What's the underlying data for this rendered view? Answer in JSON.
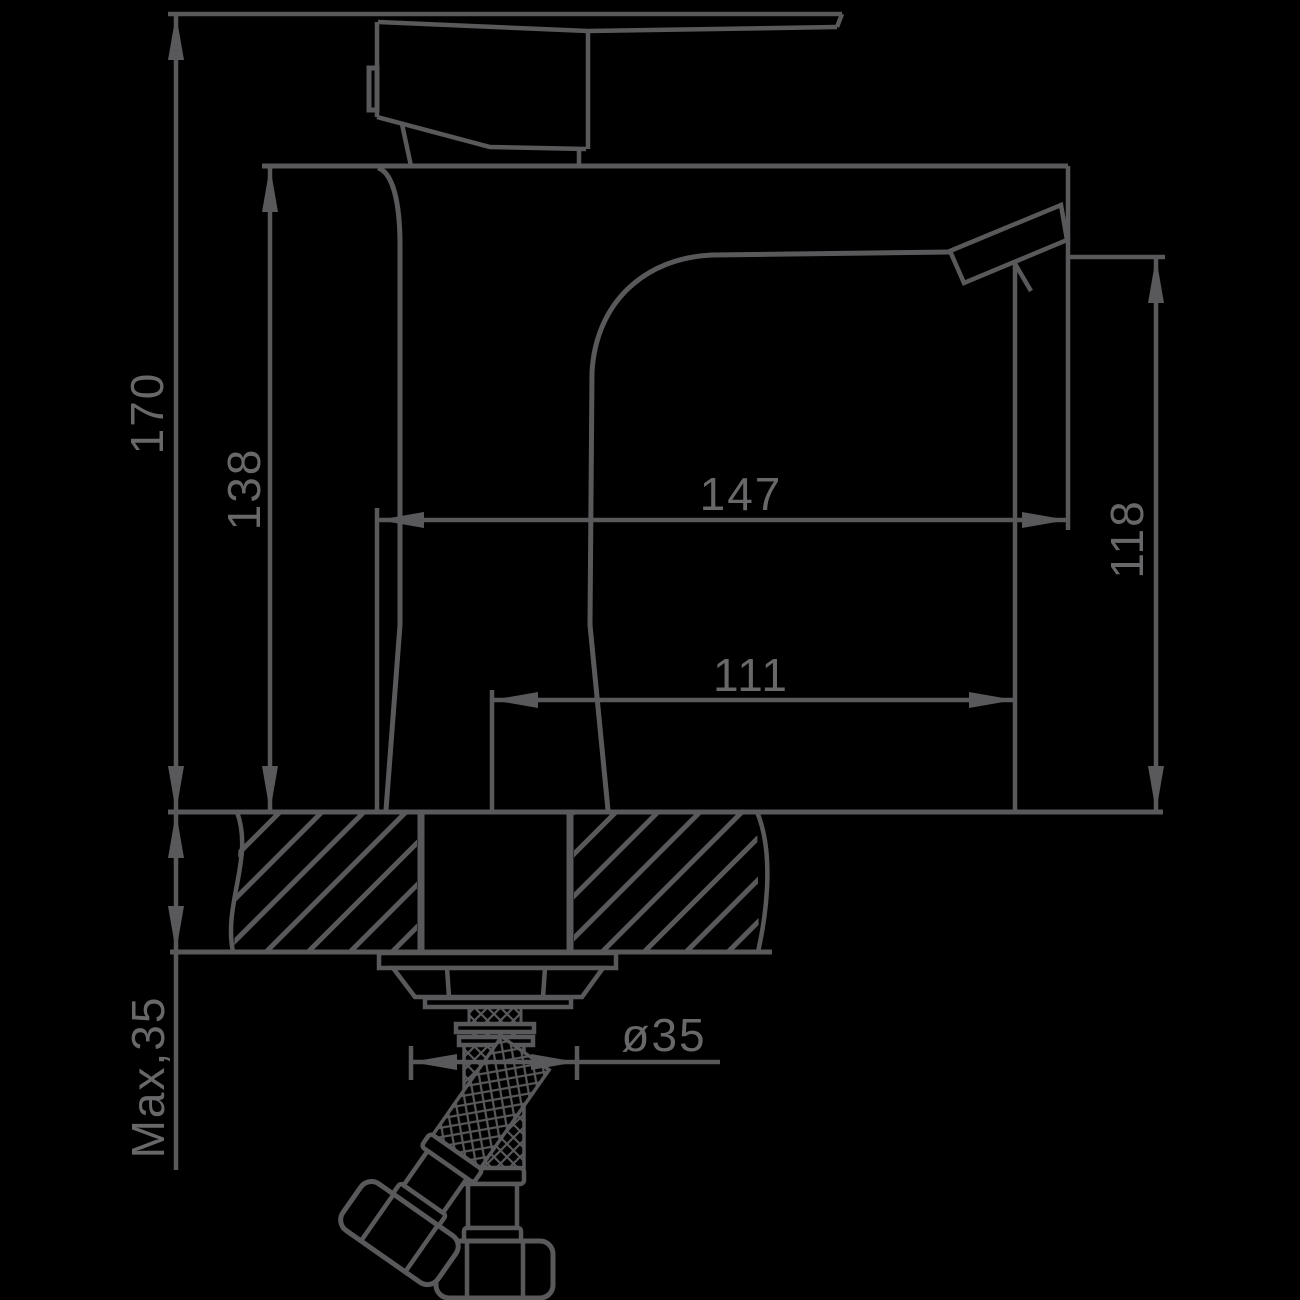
{
  "drawing": {
    "background_color": "#000000",
    "line_color": "#59595b",
    "text_color": "#68686a",
    "dimensions": {
      "total_height": {
        "label": "170"
      },
      "body_height": {
        "label": "138"
      },
      "total_length": {
        "label": "147"
      },
      "spout_reach": {
        "label": "111"
      },
      "spout_height": {
        "label": "118"
      },
      "hole_diameter": {
        "label": "ø35"
      },
      "max_deck_thickness": {
        "label": "Max,35"
      }
    }
  }
}
